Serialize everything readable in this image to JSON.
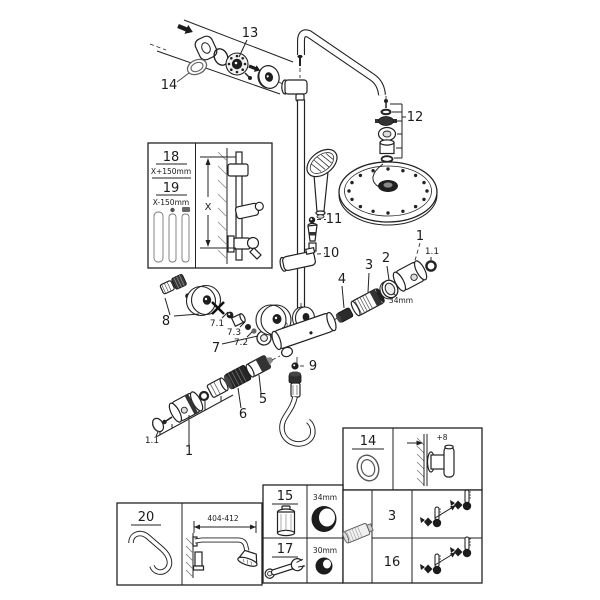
{
  "diagram": {
    "callouts": {
      "c1": "1",
      "c1_1": "1.1",
      "c2": "2",
      "c3": "3",
      "c4": "4",
      "c5": "5",
      "c6": "6",
      "c7": "7",
      "c7_1": "7.1",
      "c7_2": "7.2",
      "c7_3": "7.3",
      "c8": "8",
      "c9": "9",
      "c10": "10",
      "c11": "11",
      "c12": "12",
      "c13": "13",
      "c14": "14"
    },
    "dimensions": {
      "d34": "34mm",
      "d30": "30mm"
    },
    "inset": {
      "item_a": "18",
      "item_a_len": "X+150mm",
      "item_b": "19",
      "item_b_len": "X-150mm",
      "axis": "X"
    }
  },
  "tables": {
    "seal": {
      "part": "14",
      "offset": "+8"
    },
    "tools": {
      "top_part": "15",
      "top_size": "34mm",
      "bottom_part": "17",
      "bottom_size": "30mm"
    },
    "thermo": {
      "top": "3",
      "bottom": "16"
    },
    "arm": {
      "part": "20",
      "range": "404-412"
    }
  }
}
